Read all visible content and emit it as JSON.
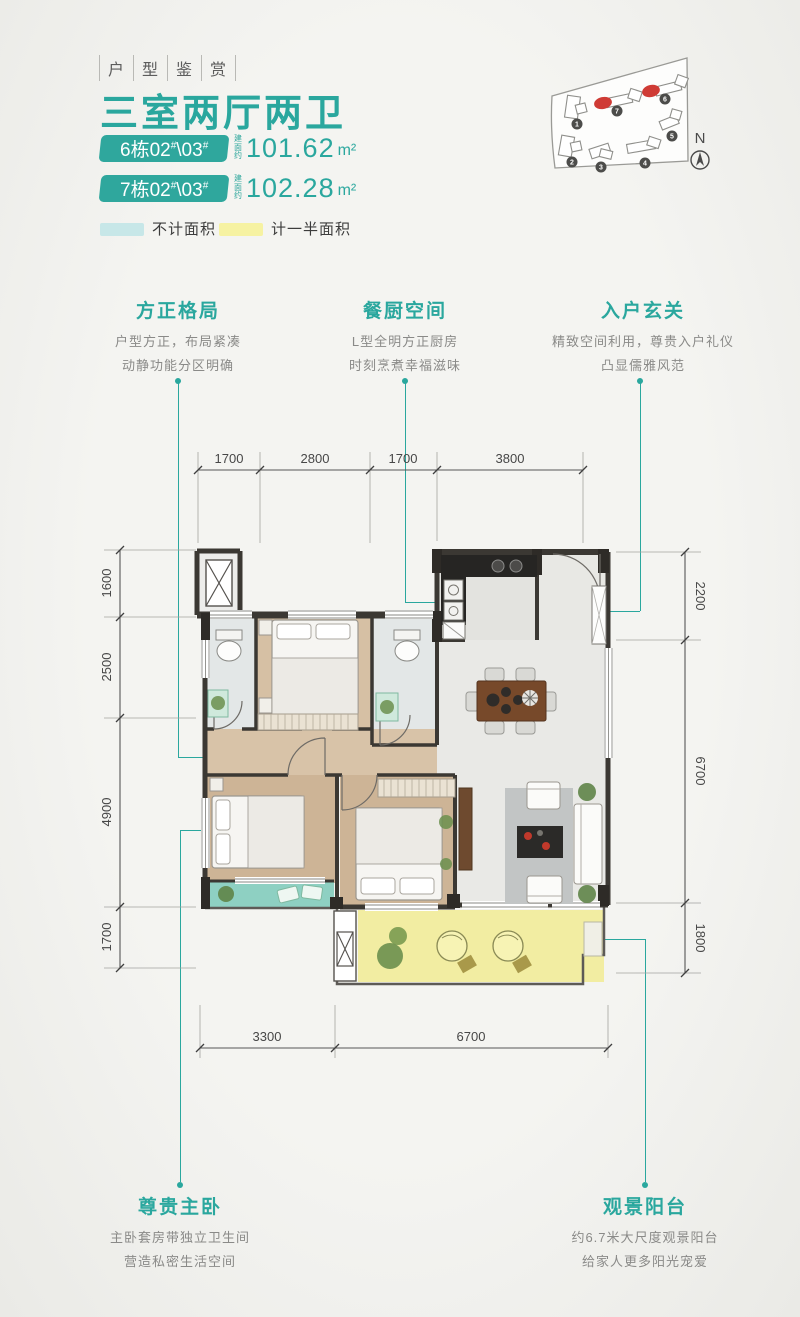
{
  "colors": {
    "accent_teal": "#2aa79e",
    "badge_teal": "#2fa79d",
    "legend_blue": "#c7e7e8",
    "legend_yellow": "#f6f2a2",
    "balcony_yellow": "#f2eda2",
    "balcony_teal": "#8ed0c2",
    "highlight_red": "#cf3b35",
    "wall_dark": "#3b3833"
  },
  "header": {
    "tagline": [
      "户",
      "型",
      "鉴",
      "赏"
    ],
    "title": "三室两厅两卫"
  },
  "common": {
    "hash": "#",
    "sep": "\\"
  },
  "units": [
    {
      "badge_left": "6栋02",
      "badge_right": "03",
      "area_label": "建面约",
      "area": "101.62",
      "area_unit": "m²"
    },
    {
      "badge_left": "7栋02",
      "badge_right": "03",
      "area_label": "建面约",
      "area": "102.28",
      "area_unit": "m²"
    }
  ],
  "legend": [
    {
      "label": "不计面积",
      "color": "#c7e7e8"
    },
    {
      "label": "计一半面积",
      "color": "#f6f2a2"
    }
  ],
  "siteplan": {
    "north_label": "N",
    "buildings": [
      {
        "num": "1"
      },
      {
        "num": "2"
      },
      {
        "num": "3"
      },
      {
        "num": "4"
      },
      {
        "num": "5"
      },
      {
        "num": "6"
      },
      {
        "num": "7"
      }
    ],
    "highlighted": [
      "6",
      "7"
    ]
  },
  "callouts": {
    "fangzheng": {
      "title": "方正格局",
      "line1": "户型方正，布局紧凑",
      "line2": "动静功能分区明确"
    },
    "canchu": {
      "title": "餐厨空间",
      "line1": "L型全明方正厨房",
      "line2": "时刻烹煮幸福滋味"
    },
    "ruhu": {
      "title": "入户玄关",
      "line1": "精致空间利用，尊贵入户礼仪",
      "line2": "凸显儒雅风范"
    },
    "zhuwo": {
      "title": "尊贵主卧",
      "line1": "主卧套房带独立卫生间",
      "line2": "营造私密生活空间"
    },
    "yangtai": {
      "title": "观景阳台",
      "line1": "约6.7米大尺度观景阳台",
      "line2": "给家人更多阳光宠爱"
    }
  },
  "plan": {
    "dims": {
      "top": [
        "1700",
        "2800",
        "1700",
        "3800"
      ],
      "left": [
        "1600",
        "2500",
        "4900",
        "1700"
      ],
      "right": [
        "2200",
        "6700",
        "1800"
      ],
      "bottom": [
        "3300",
        "6700"
      ]
    }
  }
}
